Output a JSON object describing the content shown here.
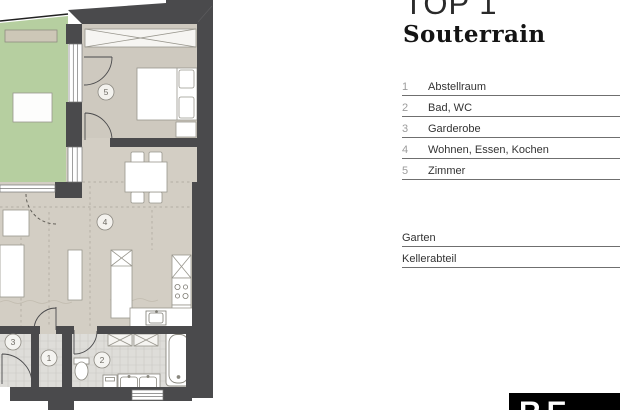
{
  "header": {
    "title": "TOP 1",
    "subtitle": "Souterrain"
  },
  "legend": [
    {
      "num": "1",
      "label": "Abstellraum"
    },
    {
      "num": "2",
      "label": "Bad, WC"
    },
    {
      "num": "3",
      "label": "Garderobe"
    },
    {
      "num": "4",
      "label": "Wohnen, Essen, Kochen"
    },
    {
      "num": "5",
      "label": "Zimmer"
    }
  ],
  "extras": [
    {
      "label": "Garten"
    },
    {
      "label": "Kellerabteil"
    }
  ],
  "plan": {
    "markers": {
      "m1": "1",
      "m2": "2",
      "m3": "3",
      "m4": "4",
      "m5": "5"
    }
  },
  "logo": {
    "text": "RE"
  },
  "colors": {
    "wall": "#4a4a4c",
    "garden": "#b6cfa0",
    "living_floor": "#d3cec4",
    "bedroom_floor": "#cec9bf",
    "tile_floor": "#deddd9"
  }
}
